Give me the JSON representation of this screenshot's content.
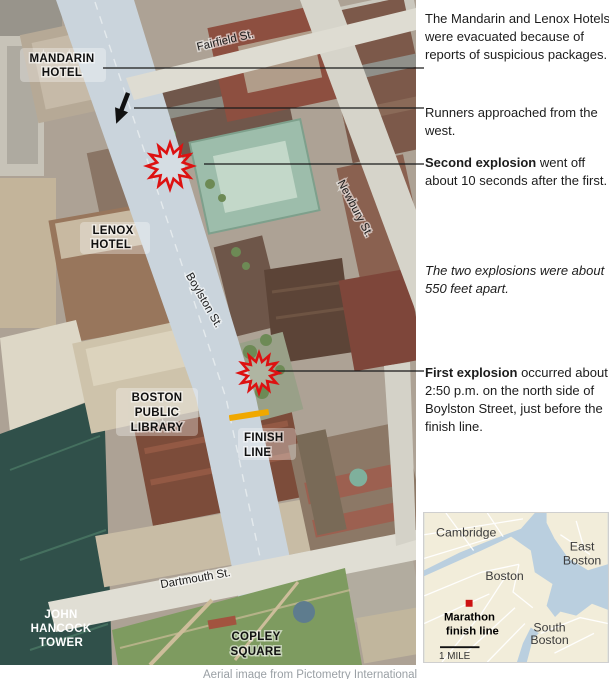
{
  "notes": [
    {
      "bold": "",
      "rest": "The Mandarin and Lenox Hotels were evacuated because of reports of suspicious packages."
    },
    {
      "bold": "",
      "rest": "Runners approached from the west."
    },
    {
      "bold": "Second explosion",
      "rest": " went off about 10 seconds after the first."
    },
    {
      "bold": "",
      "rest": "The two explosions were about 550 feet apart."
    },
    {
      "bold": "First explosion",
      "rest": " occurred about 2:50 p.m. on the north side of Boylston Street, just before the finish line."
    }
  ],
  "map": {
    "place_labels": {
      "mandarin": [
        "MANDARIN",
        "HOTEL"
      ],
      "lenox": [
        "LENOX",
        "HOTEL"
      ],
      "bpl": [
        "BOSTON",
        "PUBLIC",
        "LIBRARY"
      ],
      "finish": [
        "FINISH",
        "LINE"
      ],
      "hancock": [
        "JOHN",
        "HANCOCK",
        "TOWER"
      ],
      "copley": [
        "COPLEY",
        "SQUARE"
      ]
    },
    "street_labels": {
      "fairfield": "Fairfield St.",
      "newbury": "Newbury St.",
      "boylston": "Boylston St.",
      "dartmouth": "Dartmouth St."
    }
  },
  "inset": {
    "labels": {
      "cambridge": "Cambridge",
      "boston": "Boston",
      "east_boston": [
        "East",
        "Boston"
      ],
      "south_boston": [
        "South",
        "Boston"
      ],
      "marker": [
        "Marathon",
        "finish line"
      ]
    },
    "scale": "1 MILE"
  },
  "caption": "Aerial image from Pictometry International",
  "colors": {
    "explosion_red": "#dd1111",
    "finish_line_yellow": "#f0a800",
    "inset_marker_red": "#cc1111",
    "boylston_highlight": "#cad4dc"
  },
  "icons": {
    "explosion": "12-point starburst",
    "runner_direction": "downward arrow"
  }
}
